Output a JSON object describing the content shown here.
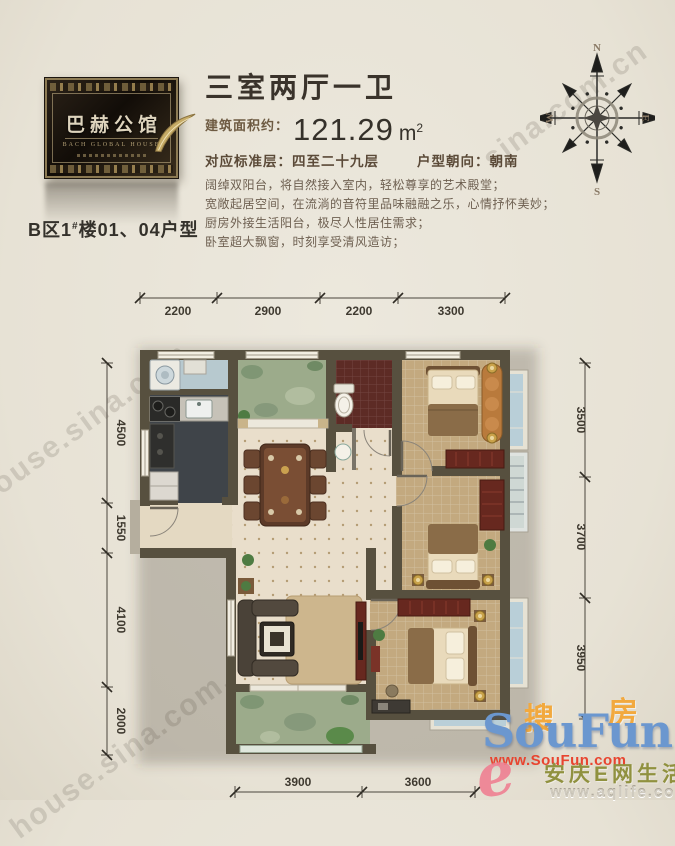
{
  "logo": {
    "name_cn": "巴赫公馆",
    "name_en": "BACH GLOBAL HOUSE",
    "unit_prefix": "B区1",
    "unit_sup": "#",
    "unit_suffix": "楼01、04户型"
  },
  "header": {
    "title": "三室两厅一卫",
    "area_label": "建筑面积约：",
    "area_value": "121.29",
    "area_unit_base": "m",
    "area_unit_sup": "2",
    "floor_info": "对应标准层：四至二十九层",
    "orientation_info": "户型朝向：朝南",
    "description_lines": [
      "阔绰双阳台，将自然接入室内，轻松尊享的艺术殿堂；",
      "宽敞起居空间，在流淌的音符里品味融融之乐，心情抒怀美妙；",
      "厨房外接生活阳台，极尽人性居住需求；",
      "卧室超大飘窗，时刻享受清风造访；"
    ]
  },
  "compass": {
    "north": "N",
    "south": "S",
    "west": "W",
    "east": "E"
  },
  "dimensions": {
    "top": [
      "2200",
      "2900",
      "2200",
      "3300"
    ],
    "left": [
      "4500",
      "1550",
      "4100",
      "2000"
    ],
    "right": [
      "3500",
      "3700",
      "3950"
    ],
    "bottom": [
      "3900",
      "3600"
    ]
  },
  "watermarks": {
    "sina_top_right": "sina.com.cn",
    "sina_left": "house.sina.com",
    "sina_bottom": "house.sina.com.cn",
    "soufun_cn_left": "搜",
    "soufun_cn_right": "房",
    "soufun_en": "SouFun",
    "soufun_url": "www.SouFun.com",
    "aqlife_e": "e",
    "aqlife_name": "安庆E网生活",
    "aqlife_url": "www.aqlife.com"
  },
  "colors": {
    "wall": "#57503f",
    "bedroom_floor": "#c3a97f",
    "bathroom_floor": "#5d2b25",
    "balcony_green": "#9cab8b",
    "window_blue": "#b9cfd8",
    "soufun_orange": "#f2a93e",
    "soufun_blue": "#6b97cf",
    "soufun_red": "#e8442f",
    "aqlife_pink": "#ef8092",
    "aqlife_olive": "#90913f"
  }
}
